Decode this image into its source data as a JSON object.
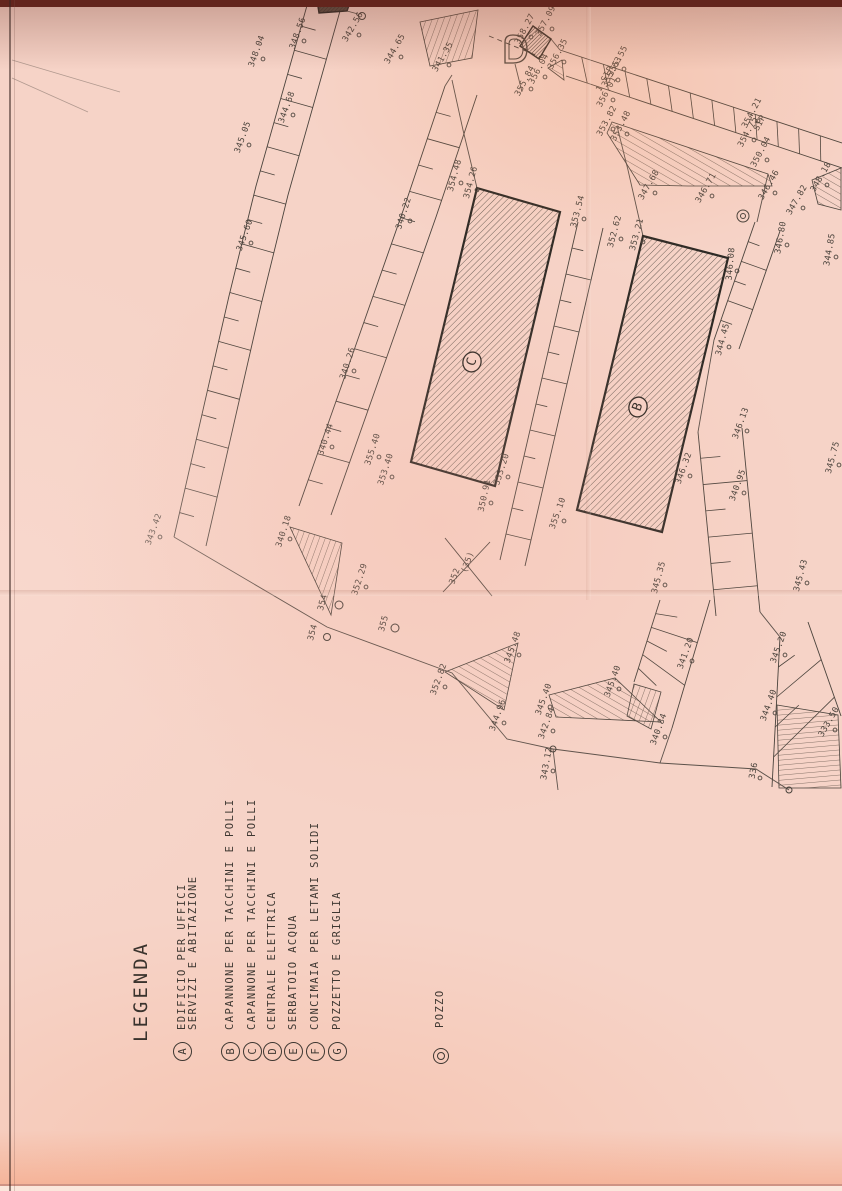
{
  "colors": {
    "paper": "#f6d3c7",
    "ink": "#4a433c",
    "building_stroke": "#2e2a25",
    "scan_edge": "#63251d"
  },
  "legend": {
    "title": "LEGENDA",
    "title_pos": {
      "x": 130,
      "y": 1042
    },
    "items": [
      {
        "key": "A",
        "x": 182,
        "lines": [
          "EDIFICIO PER UFFICI",
          "SERVIZI E ABITAZIONE"
        ]
      },
      {
        "key": "B",
        "x": 230,
        "lines": [
          "CAPANNONE PER TACCHINI E POLLI"
        ]
      },
      {
        "key": "C",
        "x": 252,
        "lines": [
          "CAPANNONE PER TACCHINI E POLLI"
        ]
      },
      {
        "key": "D",
        "x": 272,
        "lines": [
          "CENTRALE ELETTRICA"
        ]
      },
      {
        "key": "E",
        "x": 293,
        "lines": [
          "SERBATOIO ACQUA"
        ]
      },
      {
        "key": "F",
        "x": 315,
        "lines": [
          "CONCIMAIA PER LETAMI SOLIDI"
        ]
      },
      {
        "key": "G",
        "x": 337,
        "lines": [
          "POZZETTO E GRIGLIA"
        ]
      }
    ],
    "well": {
      "label": "POZZO",
      "x": 434,
      "y": 1028,
      "cx": 433,
      "cy": 1048
    }
  },
  "plan": {
    "buildings": [
      {
        "id": "C",
        "pts": [
          [
            477,
            188
          ],
          [
            560,
            212
          ],
          [
            495,
            486
          ],
          [
            411,
            462
          ]
        ],
        "label": "C",
        "lx": 472,
        "ly": 362
      },
      {
        "id": "B",
        "pts": [
          [
            643,
            236
          ],
          [
            728,
            258
          ],
          [
            662,
            532
          ],
          [
            577,
            510
          ]
        ],
        "label": "B",
        "lx": 638,
        "ly": 407
      },
      {
        "id": "D-hut",
        "pts": [
          [
            533,
            26
          ],
          [
            551,
            39
          ],
          [
            539,
            59
          ],
          [
            520,
            46
          ]
        ],
        "dense": true
      },
      {
        "id": "A-partial",
        "pts": [
          [
            317,
            0
          ],
          [
            351,
            0
          ],
          [
            347,
            11
          ],
          [
            319,
            13
          ]
        ],
        "dense": true,
        "dark": true
      }
    ],
    "strips": [
      {
        "l1": [
          [
            308,
            2
          ],
          [
            256,
            186
          ],
          [
            229,
            296
          ],
          [
            174,
            537
          ]
        ],
        "l2": [
          [
            340,
            11
          ],
          [
            288,
            195
          ],
          [
            261,
            305
          ],
          [
            206,
            546
          ]
        ],
        "n": 22,
        "alt": true
      },
      {
        "l1": [
          [
            445,
            86
          ],
          [
            404,
            208
          ],
          [
            352,
            356
          ],
          [
            299,
            506
          ]
        ],
        "l2": [
          [
            477,
            95
          ],
          [
            436,
            217
          ],
          [
            384,
            365
          ],
          [
            331,
            515
          ]
        ],
        "n": 16,
        "alt": true
      },
      {
        "l1": [
          [
            578,
            222
          ],
          [
            500,
            560
          ]
        ],
        "l2": [
          [
            603,
            228
          ],
          [
            525,
            566
          ]
        ],
        "n": 13,
        "alt": true
      },
      {
        "l1": [
          [
            755,
            222
          ],
          [
            714,
            340
          ]
        ],
        "l2": [
          [
            780,
            231
          ],
          [
            739,
            349
          ]
        ],
        "n": 6,
        "alt": true
      },
      {
        "l1": [
          [
            698,
            432
          ],
          [
            716,
            616
          ]
        ],
        "l2": [
          [
            742,
            428
          ],
          [
            760,
            612
          ]
        ],
        "n": 7,
        "alt": true
      },
      {
        "l1": [
          [
            660,
            600
          ],
          [
            634,
            682
          ]
        ],
        "l2": [
          [
            710,
            600
          ],
          [
            672,
            728
          ]
        ],
        "n": 6,
        "alt": true
      },
      {
        "l1": [
          [
            780,
            637
          ],
          [
            772,
            787
          ]
        ],
        "l2": [
          [
            808,
            622
          ],
          [
            841,
            716
          ]
        ],
        "n": 5,
        "alt": true
      },
      {
        "l1": [
          [
            560,
            50
          ],
          [
            842,
            143
          ]
        ],
        "l2": [
          [
            566,
            76
          ],
          [
            842,
            168
          ]
        ],
        "n": 13,
        "alt": false
      }
    ],
    "boundaries": [
      [
        [
          174,
          537
        ],
        [
          327,
          627
        ],
        [
          452,
          673
        ],
        [
          507,
          739
        ],
        [
          553,
          749
        ],
        [
          660,
          763
        ],
        [
          756,
          769
        ],
        [
          789,
          790
        ]
      ],
      [
        [
          553,
          749
        ],
        [
          558,
          790
        ]
      ],
      [
        [
          477,
          188
        ],
        [
          463,
          130
        ],
        [
          452,
          80
        ]
      ],
      [
        [
          643,
          236
        ],
        [
          628,
          170
        ],
        [
          617,
          126
        ]
      ],
      [
        [
          768,
          174
        ],
        [
          757,
          222
        ]
      ],
      [
        [
          714,
          340
        ],
        [
          698,
          432
        ]
      ],
      [
        [
          760,
          612
        ],
        [
          780,
          637
        ]
      ],
      [
        [
          672,
          728
        ],
        [
          660,
          763
        ]
      ],
      [
        [
          347,
          11
        ],
        [
          358,
          14
        ]
      ],
      [
        [
          515,
          64
        ],
        [
          522,
          92
        ]
      ],
      [
        [
          551,
          39
        ],
        [
          560,
          50
        ]
      ],
      [
        [
          452,
          75
        ],
        [
          445,
          86
        ]
      ]
    ],
    "faint": [
      [
        [
          12,
          60
        ],
        [
          120,
          92
        ]
      ],
      [
        [
          12,
          78
        ],
        [
          88,
          112
        ]
      ]
    ],
    "dashed": [
      [
        [
          489,
          36
        ],
        [
          543,
          58
        ]
      ]
    ],
    "slopes": [
      {
        "pts": [
          [
            290,
            527
          ],
          [
            342,
            543
          ],
          [
            331,
            615
          ]
        ],
        "f": "p20"
      },
      {
        "pts": [
          [
            445,
            672
          ],
          [
            518,
            643
          ],
          [
            504,
            710
          ]
        ],
        "f": "pm60"
      },
      {
        "pts": [
          [
            549,
            695
          ],
          [
            615,
            678
          ],
          [
            661,
            722
          ],
          [
            556,
            717
          ]
        ],
        "f": "pm60"
      },
      {
        "pts": [
          [
            777,
            705
          ],
          [
            838,
            715
          ],
          [
            841,
            788
          ],
          [
            779,
            788
          ]
        ],
        "f": "p85"
      },
      {
        "pts": [
          [
            420,
            22
          ],
          [
            478,
            10
          ],
          [
            472,
            58
          ],
          [
            430,
            66
          ]
        ],
        "f": "p20"
      },
      {
        "pts": [
          [
            812,
            180
          ],
          [
            841,
            168
          ],
          [
            841,
            210
          ],
          [
            818,
            204
          ]
        ],
        "f": "pm60"
      },
      {
        "pts": [
          [
            634,
            684
          ],
          [
            661,
            692
          ],
          [
            651,
            729
          ],
          [
            627,
            716
          ]
        ],
        "f": "p20"
      },
      {
        "pts": [
          [
            607,
            133
          ],
          [
            612,
            122
          ],
          [
            768,
            174
          ],
          [
            772,
            186
          ],
          [
            688,
            186
          ],
          [
            640,
            185
          ]
        ],
        "f": "pm60"
      },
      {
        "pts": [
          [
            548,
            68
          ],
          [
            562,
            60
          ],
          [
            564,
            80
          ]
        ],
        "f": "pm60"
      }
    ],
    "cross": [
      [
        [
          445,
          538
        ],
        [
          492,
          596
        ]
      ],
      [
        [
          490,
          542
        ],
        [
          443,
          592
        ]
      ]
    ],
    "circles": [
      {
        "x": 743,
        "y": 216,
        "r": 6
      },
      {
        "x": 743,
        "y": 216,
        "r": 2.5
      },
      {
        "x": 339,
        "y": 605,
        "r": 4
      },
      {
        "x": 395,
        "y": 628,
        "r": 4
      },
      {
        "x": 327,
        "y": 637,
        "r": 3.5
      },
      {
        "x": 362,
        "y": 16,
        "r": 3.5
      },
      {
        "x": 553,
        "y": 749,
        "r": 3
      },
      {
        "x": 789,
        "y": 790,
        "r": 3
      }
    ],
    "spot_elevations": [
      {
        "v": "342.56",
        "x": 355,
        "y": 28,
        "a": -60
      },
      {
        "v": "348.56",
        "x": 300,
        "y": 34,
        "a": -70
      },
      {
        "v": "348.04",
        "x": 259,
        "y": 52,
        "a": -70
      },
      {
        "v": "344.68",
        "x": 289,
        "y": 108,
        "a": -70
      },
      {
        "v": "345.05",
        "x": 245,
        "y": 138,
        "a": -70
      },
      {
        "v": "345.60",
        "x": 247,
        "y": 236,
        "a": -70
      },
      {
        "v": "343.42",
        "x": 156,
        "y": 530,
        "a": -70
      },
      {
        "v": "344.65",
        "x": 397,
        "y": 50,
        "a": -60
      },
      {
        "v": "341.35",
        "x": 445,
        "y": 58,
        "a": -60
      },
      {
        "v": "340.22",
        "x": 406,
        "y": 214,
        "a": -72
      },
      {
        "v": "340.26",
        "x": 350,
        "y": 364,
        "a": -72
      },
      {
        "v": "340.18",
        "x": 286,
        "y": 532,
        "a": -72
      },
      {
        "v": "340.44",
        "x": 328,
        "y": 440,
        "a": -72
      },
      {
        "v": "355.40",
        "x": 375,
        "y": 450,
        "a": -72
      },
      {
        "v": "353.40",
        "x": 388,
        "y": 470,
        "a": -72
      },
      {
        "v": "352.29",
        "x": 362,
        "y": 580,
        "a": -72
      },
      {
        "v": "354",
        "x": 325,
        "y": 603,
        "a": -75,
        "p": 0
      },
      {
        "v": "355",
        "x": 386,
        "y": 624,
        "a": -75,
        "p": 0
      },
      {
        "v": "354",
        "x": 315,
        "y": 633,
        "a": -75,
        "p": 0
      },
      {
        "v": "354.48",
        "x": 457,
        "y": 176,
        "a": -75
      },
      {
        "v": "354.26",
        "x": 473,
        "y": 183,
        "a": -75
      },
      {
        "v": "353.54",
        "x": 580,
        "y": 212,
        "a": -75
      },
      {
        "v": "353.20",
        "x": 504,
        "y": 470,
        "a": -72
      },
      {
        "v": "350.91",
        "x": 487,
        "y": 496,
        "a": -78
      },
      {
        "v": "355.10",
        "x": 560,
        "y": 514,
        "a": -70
      },
      {
        "v": "345.48",
        "x": 515,
        "y": 648,
        "a": -70
      },
      {
        "v": "352.82",
        "x": 441,
        "y": 680,
        "a": -70
      },
      {
        "v": "352",
        "x": 457,
        "y": 577,
        "a": -70,
        "p": 0
      },
      {
        "v": "(35)",
        "x": 470,
        "y": 563,
        "a": -70,
        "p": 0
      },
      {
        "v": "352.62",
        "x": 617,
        "y": 232,
        "a": -75
      },
      {
        "v": "353.21",
        "x": 639,
        "y": 235,
        "a": -75
      },
      {
        "v": "346.08",
        "x": 733,
        "y": 264,
        "a": -85
      },
      {
        "v": "344.45",
        "x": 725,
        "y": 340,
        "a": -75
      },
      {
        "v": "346.80",
        "x": 783,
        "y": 238,
        "a": -80
      },
      {
        "v": "344.85",
        "x": 832,
        "y": 250,
        "a": -80
      },
      {
        "v": "345.40",
        "x": 546,
        "y": 700,
        "a": -70
      },
      {
        "v": "344.96",
        "x": 500,
        "y": 716,
        "a": -70
      },
      {
        "v": "342.84",
        "x": 549,
        "y": 724,
        "a": -70
      },
      {
        "v": "343.12",
        "x": 549,
        "y": 764,
        "a": -80
      },
      {
        "v": "345.40",
        "x": 615,
        "y": 682,
        "a": -70
      },
      {
        "v": "340.84",
        "x": 661,
        "y": 730,
        "a": -70
      },
      {
        "v": "341.20",
        "x": 688,
        "y": 654,
        "a": -70
      },
      {
        "v": "358.27",
        "x": 527,
        "y": 30,
        "a": -62
      },
      {
        "v": "357.09",
        "x": 548,
        "y": 22,
        "a": -62
      },
      {
        "v": "356.35",
        "x": 560,
        "y": 55,
        "a": -62
      },
      {
        "v": "356.04",
        "x": 541,
        "y": 70,
        "a": -62
      },
      {
        "v": "355.84",
        "x": 527,
        "y": 82,
        "a": -62
      },
      {
        "v": "355.55",
        "x": 620,
        "y": 62,
        "a": -62
      },
      {
        "v": "355.63",
        "x": 614,
        "y": 73,
        "a": -62
      },
      {
        "v": "1 SIP",
        "x": 607,
        "y": 80,
        "a": -62,
        "p": 0
      },
      {
        "v": "356.01",
        "x": 609,
        "y": 93,
        "a": -62
      },
      {
        "v": "353.82",
        "x": 609,
        "y": 122,
        "a": -62
      },
      {
        "v": "353.48",
        "x": 623,
        "y": 127,
        "a": -62
      },
      {
        "v": "354.21",
        "x": 754,
        "y": 114,
        "a": -62
      },
      {
        "v": "SIP",
        "x": 762,
        "y": 124,
        "a": -62,
        "p": 0
      },
      {
        "v": "354.75",
        "x": 750,
        "y": 133,
        "a": -62
      },
      {
        "v": "350.04",
        "x": 763,
        "y": 153,
        "a": -62
      },
      {
        "v": "347.68",
        "x": 651,
        "y": 186,
        "a": -60
      },
      {
        "v": "346.71",
        "x": 708,
        "y": 189,
        "a": -60
      },
      {
        "v": "346.46",
        "x": 771,
        "y": 186,
        "a": -60
      },
      {
        "v": "347.82",
        "x": 799,
        "y": 201,
        "a": -60
      },
      {
        "v": "348.18",
        "x": 823,
        "y": 178,
        "a": -60
      },
      {
        "v": "346.13",
        "x": 743,
        "y": 424,
        "a": -70
      },
      {
        "v": "346.32",
        "x": 686,
        "y": 469,
        "a": -70
      },
      {
        "v": "340.95",
        "x": 740,
        "y": 486,
        "a": -70
      },
      {
        "v": "345.35",
        "x": 661,
        "y": 578,
        "a": -75
      },
      {
        "v": "345.43",
        "x": 803,
        "y": 576,
        "a": -75
      },
      {
        "v": "345.75",
        "x": 835,
        "y": 458,
        "a": -75
      },
      {
        "v": "333.50",
        "x": 831,
        "y": 723,
        "a": -60
      },
      {
        "v": "336",
        "x": 756,
        "y": 771,
        "a": -80
      },
      {
        "v": "344.40",
        "x": 771,
        "y": 706,
        "a": -70
      },
      {
        "v": "345.20",
        "x": 781,
        "y": 648,
        "a": -70
      }
    ]
  }
}
